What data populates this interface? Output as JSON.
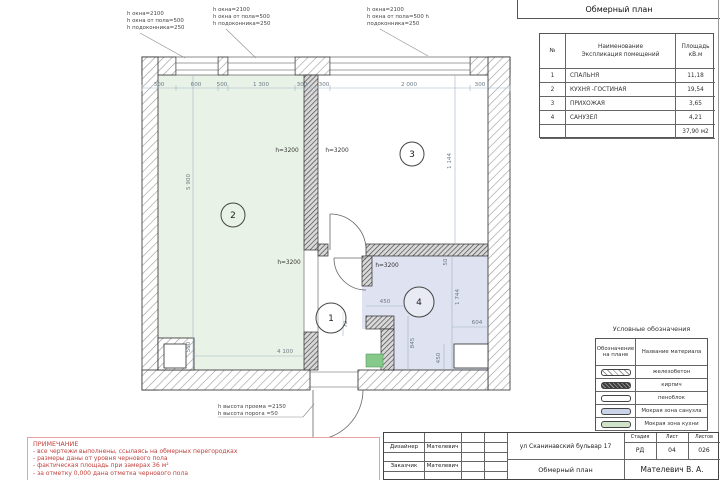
{
  "sheet": {
    "header_title": "Обмерный план"
  },
  "room_table": {
    "col_no": "№",
    "col_name_line1": "Наименование",
    "col_name_line2": "Экспликация помещений",
    "col_area_line1": "Площадь",
    "col_area_line2": "кВ.м",
    "rows": [
      {
        "no": "1",
        "name": "СПАЛЬНЯ",
        "area": "11,18"
      },
      {
        "no": "2",
        "name": "КУХНЯ -ГОСТИНАЯ",
        "area": "19,54"
      },
      {
        "no": "3",
        "name": "ПРИХОЖАЯ",
        "area": "3,65"
      },
      {
        "no": "4",
        "name": "САНУЗЕЛ",
        "area": "4,21"
      }
    ],
    "total_area": "37,90 м2"
  },
  "legend": {
    "title": "Условные обозначения",
    "col_symbol_line1": "Обозначение",
    "col_symbol_line2": "на плане",
    "col_material": "Название материала",
    "rows": [
      {
        "material": "железобетон",
        "swatch": "concrete-hatch"
      },
      {
        "material": "кирпич",
        "swatch": "brick-hatch"
      },
      {
        "material": "пеноблок",
        "swatch": "plain"
      },
      {
        "material": "Мокрая зона санузла",
        "swatch": "blue-fill"
      },
      {
        "material": "Мокрая зона кухни",
        "swatch": "green-fill"
      }
    ]
  },
  "notes": {
    "title": "ПРИМЕЧАНИЕ",
    "lines": [
      "- все чертежи выполнены, ссылаясь на обмерных перегородках",
      "- размеры даны от уровня чернового пола",
      "- фактическая площадь при замерах 36 м²",
      "- за отметку 0,000 дана отметка чернового пола"
    ]
  },
  "titleblock": {
    "designer_label": "Дизайнер",
    "designer_name": "Мателевич",
    "client_label": "Заказчик",
    "client_name": "Мателевич",
    "address": "ул Сканинавский бульвар 17",
    "stage_label": "Стадия",
    "sheet_label": "Лист",
    "sheets_label": "Листов",
    "stage": "РД",
    "sheet_no": "04",
    "sheets_total": "026",
    "drawing_title": "Обмерный план",
    "author": "Мателевич В. А."
  },
  "plan": {
    "rooms": [
      {
        "number": "1"
      },
      {
        "number": "2"
      },
      {
        "number": "3"
      },
      {
        "number": "4"
      }
    ],
    "window_note_1": {
      "l1": "h окна=2100",
      "l2": "h окна от пола=500",
      "l3": "h подоконника=250"
    },
    "window_note_2": {
      "l1": "h окна=2100",
      "l2": "h окна от пола=500",
      "l3": "h подоконника=250"
    },
    "window_note_3": {
      "l1": "h окна=2100",
      "l2": "h окна от пола=500 h",
      "l3": "подоконника=250"
    },
    "door_note": {
      "l1": "h высота проема =2150",
      "l2": "h высота порога =50"
    },
    "dims_top": [
      "300",
      "600",
      "500",
      "1 300",
      "300",
      "300",
      "2 000",
      "300"
    ],
    "dims": {
      "room2_height": "5 900",
      "room2_bottom": "500",
      "room2_width": "4 100",
      "ceiling_1": "h=3200",
      "ceiling_2": "h=3200",
      "ceiling_3": "h=3200",
      "ceiling_4": "h=3200",
      "door_width": "450",
      "wall_gap": "50",
      "room4_height": "1 744",
      "room4_width": "604",
      "room4_inner": "845",
      "room4_bottom": "450",
      "hall_dim": "72",
      "room3_height": "1 144"
    }
  },
  "colors": {
    "room_kitchen_fill": "#e9f2e6",
    "room_bath_fill": "#dfe2f0",
    "wet_zone_green": "#85c98b",
    "note_red": "#c0403c"
  }
}
